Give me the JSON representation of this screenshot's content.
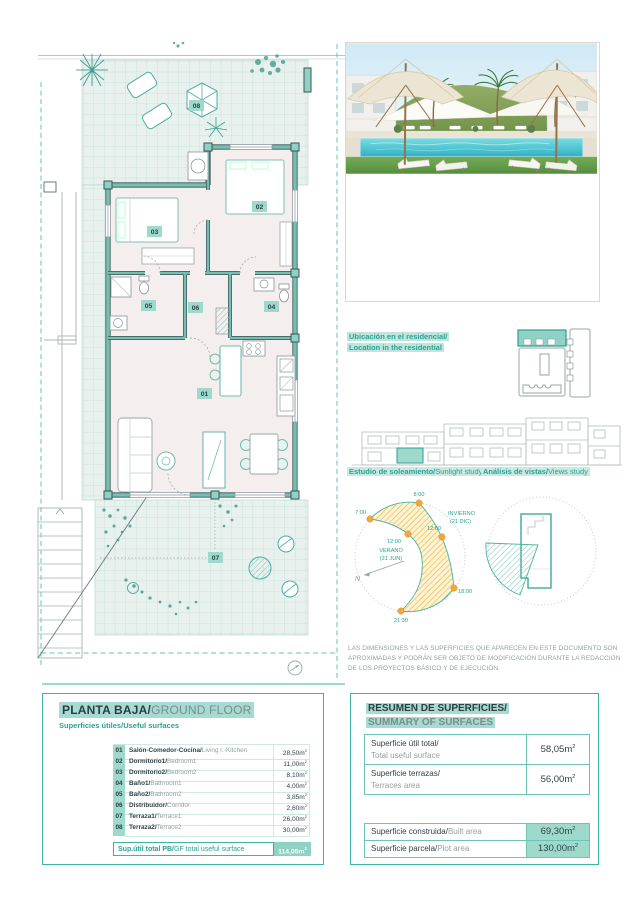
{
  "unit": {
    "base": "m",
    "sup": "2"
  },
  "plan": {
    "room_labels": [
      "01",
      "02",
      "03",
      "04",
      "05",
      "06",
      "07",
      "08"
    ]
  },
  "location": {
    "title_es": "Ubicación en el residencial/",
    "title_en": "Location in the residential"
  },
  "sunlight": {
    "title_es": "Estudio de soleamiento/",
    "title_en": "Sunlight study",
    "hours": {
      "h7": "7:00",
      "h8": "8:00",
      "h12_summer": "12:00",
      "h12_winter": "12:00",
      "h18": "18:00",
      "h2130": "21:30"
    },
    "summer": "VERANO",
    "summer_date": "(21 JUN)",
    "winter": "INVIERNO",
    "winter_date": "(21 DIC)",
    "north": "N"
  },
  "views": {
    "title_es": "Análisis de vistas/",
    "title_en": "Views study"
  },
  "disclaimer": "LAS DIMENSIONES Y LAS SUPERFICIES QUE APARECEN EN ESTE DOCUMENTO SON APROXIMADAS Y PODRÁN SER OBJETO DE MODIFICACIÓN DURANTE LA REDACCIÓN DE LOS PROYECTOS BÁSICO Y DE EJECUCIÓN.",
  "ground_floor": {
    "title_es": "PLANTA BAJA/",
    "title_en": "GROUND FLOOR",
    "subtitle": "Superficies útiles/Useful surfaces",
    "rows": [
      {
        "num": "01",
        "es": "Salón-Comedor-Cocina/",
        "en": "Living r.-Kitchen",
        "area": "28,50"
      },
      {
        "num": "02",
        "es": "Dormitorio1/",
        "en": "Bedroom1",
        "area": "11,00"
      },
      {
        "num": "03",
        "es": "Dormitorio2/",
        "en": "Bedroom2",
        "area": "8,10"
      },
      {
        "num": "04",
        "es": "Baño1/",
        "en": "Bathroom1",
        "area": "4,00"
      },
      {
        "num": "05",
        "es": "Baño2/",
        "en": "Bathroom2",
        "area": "3,85"
      },
      {
        "num": "06",
        "es": "Distribuidor/",
        "en": "Corridor",
        "area": "2,60"
      },
      {
        "num": "07",
        "es": "Terraza1/",
        "en": "Terrace1",
        "area": "26,00"
      },
      {
        "num": "08",
        "es": "Terraza2/",
        "en": "Terrace2",
        "area": "30,00"
      }
    ],
    "total_es": "Sup.útil total PB/",
    "total_en": "GF total useful surface",
    "total_area": "114,05"
  },
  "summary": {
    "title_es": "RESUMEN DE SUPERFICIES/",
    "title_en": "SUMMARY OF SURFACES",
    "useful": {
      "es": "Superficie útil total/",
      "en": "Total useful surface",
      "area": "58,05"
    },
    "terraces": {
      "es": "Superficie terrazas/",
      "en": "Terraces area",
      "area": "56,00"
    },
    "built": {
      "es": "Superficie construida/",
      "en": "Built area",
      "area": "69,30"
    },
    "plot": {
      "es": "Superficie parcela/",
      "en": "Plot area",
      "area": "130,00"
    }
  },
  "colors": {
    "accent_teal": "#2aa194",
    "mint_highlight": "#a5dbd0",
    "wall_teal": "#74c0b0",
    "sun_band_yellow": "#efbf49",
    "sun_dot_orange": "#f0a73e"
  }
}
